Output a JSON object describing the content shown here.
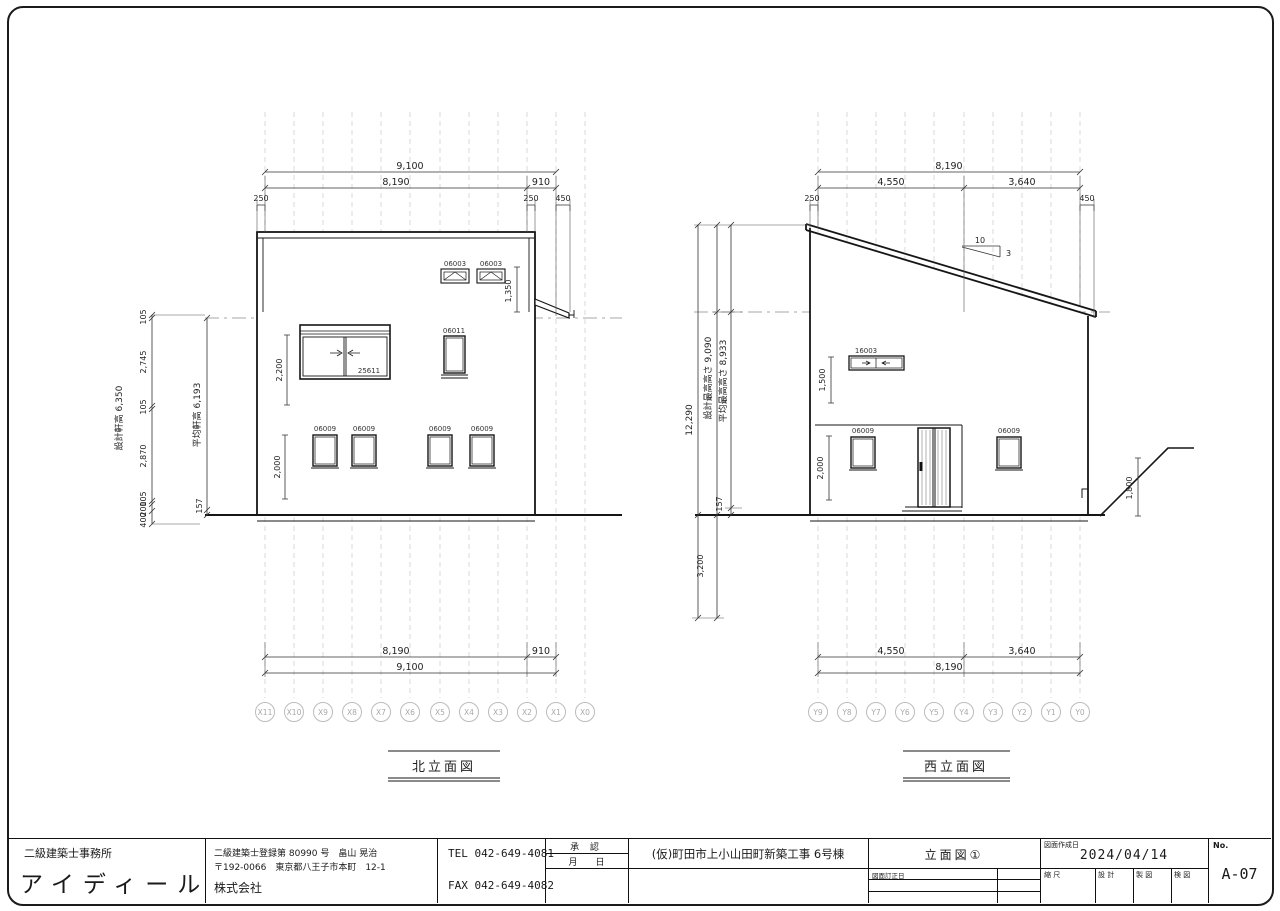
{
  "north": {
    "title": "北立面図",
    "grid_labels": [
      "X11",
      "X10",
      "X9",
      "X8",
      "X7",
      "X6",
      "X5",
      "X4",
      "X3",
      "X2",
      "X1",
      "X0"
    ],
    "dims": {
      "total": "9,100",
      "span": "8,190",
      "offset": "910",
      "off_left": "250",
      "off_mid": "250",
      "eave": "450",
      "upper_h": "1,350",
      "big_h": "2,200",
      "low_h": "2,000",
      "h_total": "設計軒高 6,350",
      "chain": [
        "105",
        "2,745",
        "105",
        "2,870",
        "105",
        "200",
        "400"
      ],
      "avg": "平均軒高 6,193",
      "gl": "157",
      "bottom_span": "8,190",
      "bottom_offset": "910",
      "bottom_total": "9,100"
    },
    "windows": {
      "upper1": "06003",
      "upper2": "06003",
      "mid": "06011",
      "big": "25611",
      "low1": "06009",
      "low2": "06009",
      "low3": "06009",
      "low4": "06009"
    }
  },
  "west": {
    "title": "西立面図",
    "grid_labels": [
      "Y9",
      "Y8",
      "Y7",
      "Y6",
      "Y5",
      "Y4",
      "Y3",
      "Y2",
      "Y1",
      "Y0"
    ],
    "dims": {
      "total": "8,190",
      "left": "4,550",
      "right": "3,640",
      "off_left": "250",
      "eave": "450",
      "slope_run": "10",
      "slope_rise": "3",
      "h_total": "12,290",
      "h_design": "設計最高高さ 9,090",
      "h_avg": "平均最高高さ 8,933",
      "gl": "157",
      "below": "3,200",
      "upper_h": "1,500",
      "low_h": "2,000",
      "ground_rise": "1,800",
      "bottom_left": "4,550",
      "bottom_right": "3,640",
      "bottom_total": "8,190"
    },
    "windows": {
      "upper": "16003",
      "low1": "06009",
      "low2": "06009"
    }
  },
  "titleblock": {
    "office_type": "二級建築士事務所",
    "office_name": "アイディール",
    "license": "二級建築士登録第 80990 号　畠山 晃治",
    "address": "〒192-0066　東京都八王子市本町　12-1",
    "company": "株式会社",
    "tel": "TEL 042-649-4081",
    "fax": "FAX 042-649-4082",
    "approval_label": "承 認",
    "month_day": "月　　日",
    "project": "(仮)町田市上小山田町新築工事 6号棟",
    "sheet_title": "立面図①",
    "created_label": "図面作成日",
    "created_date": "2024/04/14",
    "revised_label": "図面訂正日",
    "scale_label": "縮 尺",
    "design_label": "設 計",
    "draft_label": "製 図",
    "check_label": "検 図",
    "no_label": "No.",
    "sheet_no": "A-07"
  }
}
